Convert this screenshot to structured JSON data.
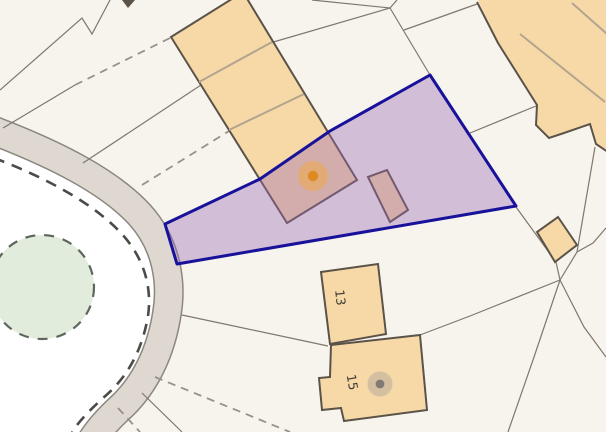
{
  "map": {
    "description": "Cadastral map view with a selected land parcel, buildings and a roundabout",
    "background_color": "#f7f4ee",
    "roundabout": {
      "inner_color": "#ffffff",
      "road_fill": "#ded8d1",
      "road_casing": "#8b8680",
      "give_way_dash_color": "#4b4b47",
      "green_area_fill": "#e2ecdd",
      "green_area_border": "#5d665d"
    },
    "selection": {
      "name": "selected-parcel",
      "fill": "rgba(152,102,179,0.38)",
      "border_color": "#18129b"
    },
    "buildings": {
      "fill": "#f7d9a8",
      "outline": "#5b5348",
      "division_line": "#b3a48e",
      "labels": [
        {
          "text": "13"
        },
        {
          "text": "15"
        }
      ]
    },
    "parcel_lines": {
      "solid_color": "#7f776c",
      "dashed_color": "#98918a"
    },
    "markers": [
      {
        "name": "selected-building-marker",
        "dot_color": "#df8a20",
        "halo_color": "#f2a93e"
      },
      {
        "name": "building-15-marker",
        "dot_color": "#7f7a72",
        "halo_color": "#a8a199"
      }
    ]
  }
}
